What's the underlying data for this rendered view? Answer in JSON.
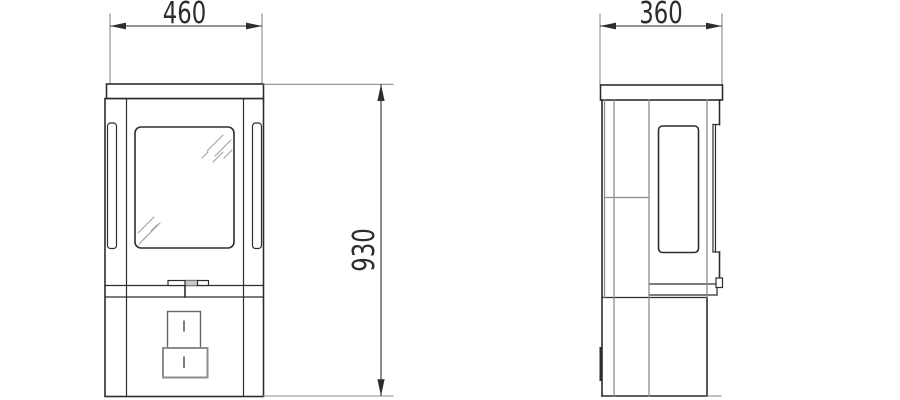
{
  "drawing": {
    "type": "technical-dimension-drawing",
    "subject": "freestanding-stove-elevations",
    "colors": {
      "outline": "#2d2d2d",
      "panel_line": "#8d8d8d",
      "hatch": "#9f9f9f",
      "handle_fill": "#c9c9c9",
      "background": "#ffffff"
    },
    "dimensions": {
      "front_width": {
        "value": "460"
      },
      "overall_height": {
        "value": "930"
      },
      "side_depth": {
        "value": "360"
      }
    }
  }
}
